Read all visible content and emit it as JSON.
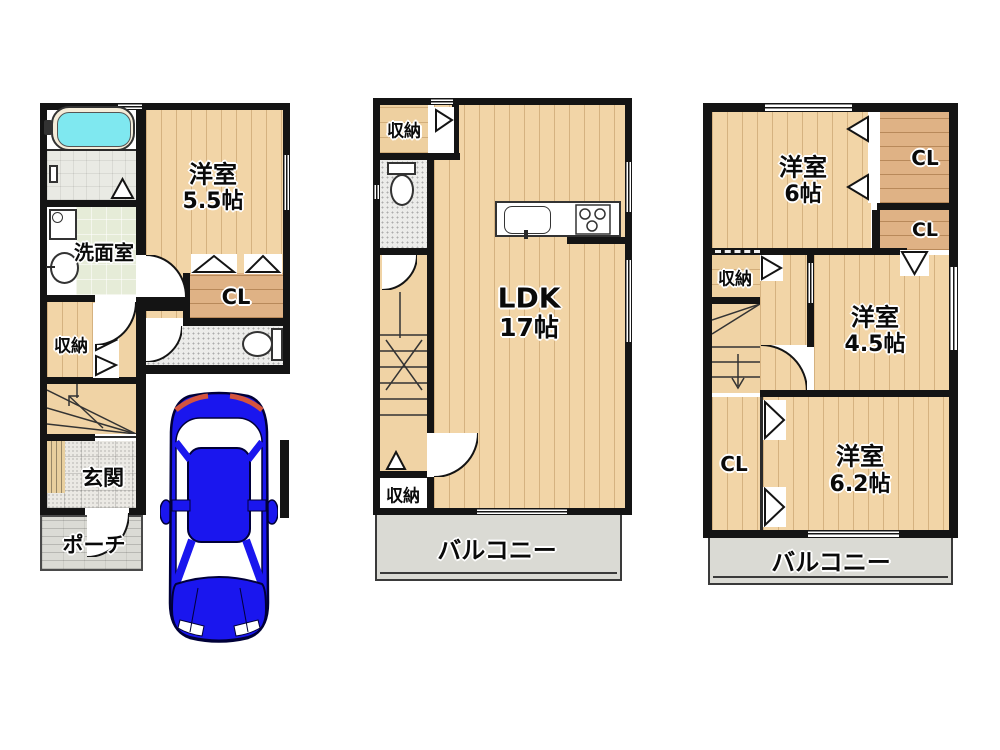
{
  "plans": {
    "floor1": {
      "bedroom": {
        "name": "洋室",
        "size": "5.5帖"
      },
      "washroom": "洗面室",
      "closet": "CL",
      "storage": "収納",
      "entrance": "玄関",
      "porch": "ポーチ"
    },
    "floor2": {
      "storage_top": "収納",
      "ldk": {
        "name": "LDK",
        "size": "17帖"
      },
      "storage_bottom": "収納",
      "balcony": "バルコニー"
    },
    "floor3": {
      "bedroom_6": {
        "name": "洋室",
        "size": "6帖"
      },
      "closet_1": "CL",
      "closet_2": "CL",
      "storage": "収納",
      "bedroom_45": {
        "name": "洋室",
        "size": "4.5帖"
      },
      "closet_3": "CL",
      "bedroom_62": {
        "name": "洋室",
        "size": "6.2帖"
      },
      "balcony": "バルコニー"
    }
  },
  "colors": {
    "wall": "#141414",
    "wood_floor": "#f2d5a7",
    "closet_floor": "#dfb285",
    "bath_water": "#7fe8f0",
    "washroom_floor": "#e6ecd8",
    "tile_floor": "#ebe9e4",
    "balcony_floor": "#dadad4",
    "car_body": "#1a16ee",
    "tail_light": "#d4543e"
  }
}
